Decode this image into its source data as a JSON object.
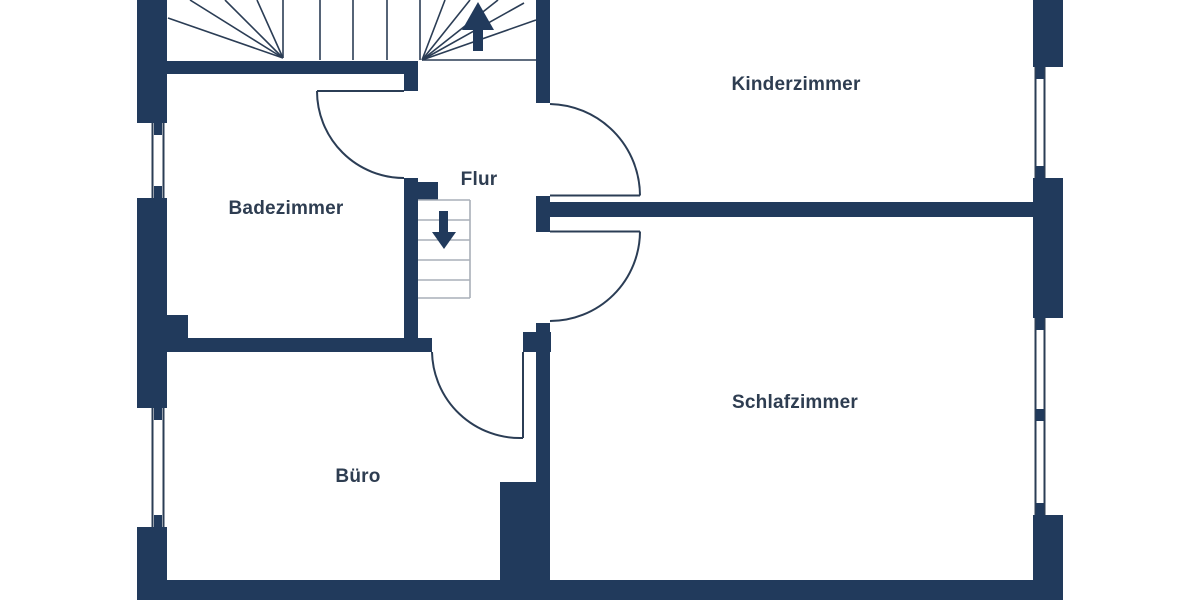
{
  "floor_plan": {
    "rooms": [
      {
        "id": "kinderzimmer",
        "label": "Kinderzimmer"
      },
      {
        "id": "badezimmer",
        "label": "Badezimmer"
      },
      {
        "id": "flur",
        "label": "Flur"
      },
      {
        "id": "schlafzimmer",
        "label": "Schlafzimmer"
      },
      {
        "id": "buero",
        "label": "Büro"
      }
    ],
    "icons": [
      {
        "name": "stairs-up-arrow-icon"
      },
      {
        "name": "stairs-down-arrow-icon"
      }
    ],
    "colors": {
      "wall": "#213a5c",
      "door_line": "#2b3d55",
      "stair_line": "#2b3d55",
      "tread_line": "#a9afb8",
      "label_text": "#2e3d51",
      "background": "#ffffff"
    }
  }
}
